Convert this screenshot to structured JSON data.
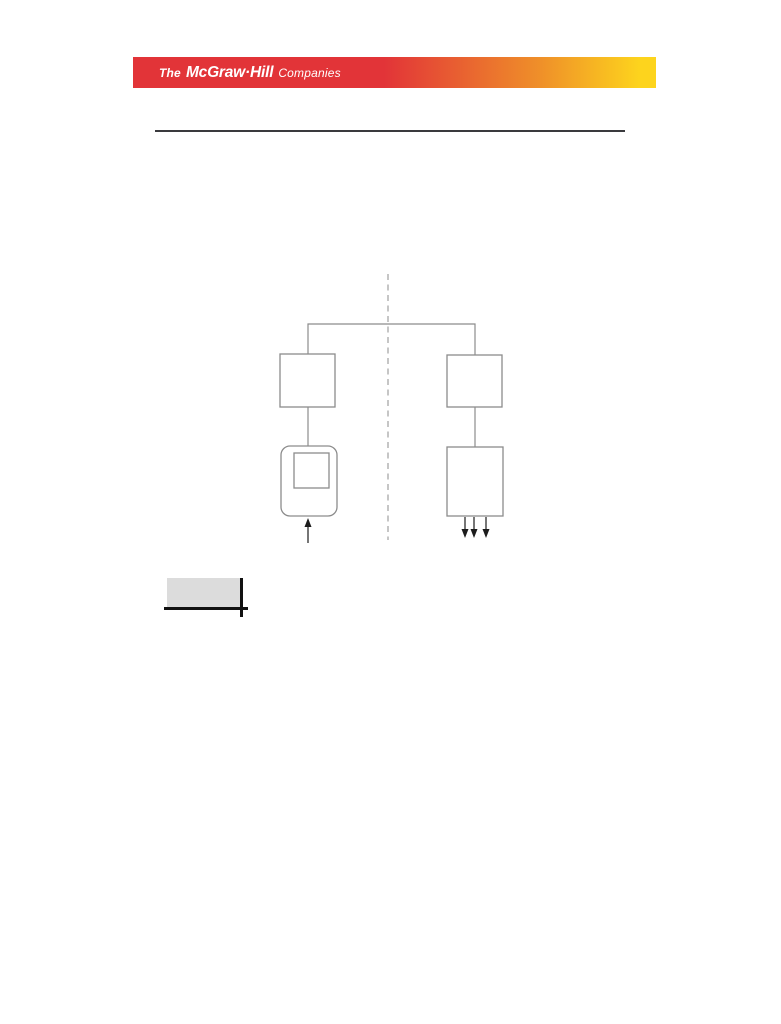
{
  "banner": {
    "logo_the": "The",
    "logo_mcgrawhill": "McGraw·Hill",
    "logo_companies": "Companies"
  },
  "figure": {
    "type": "block-diagram",
    "divider": "vertical-dashed-line",
    "left_branch": {
      "top_box": "square",
      "bottom_box": "rounded-square-with-inner-square",
      "bottom_arrows": 1,
      "bottom_arrow_direction": "up-into-box"
    },
    "right_branch": {
      "top_box": "square",
      "bottom_box": "rectangle",
      "bottom_arrows": 3,
      "bottom_arrow_direction": "down-out-of-box"
    }
  },
  "colors": {
    "banner_red": "#e23438",
    "banner_orange": "#ef9029",
    "banner_yellow": "#fdd41d",
    "banner_text": "#ffffff",
    "rule": "#3a3a3e",
    "diagram_line": "#8c8c8c",
    "diagram_dash": "#a0a0a0",
    "arrow": "#1c1c1c",
    "caption_fill": "#dcdcdc",
    "caption_line": "#111111"
  }
}
